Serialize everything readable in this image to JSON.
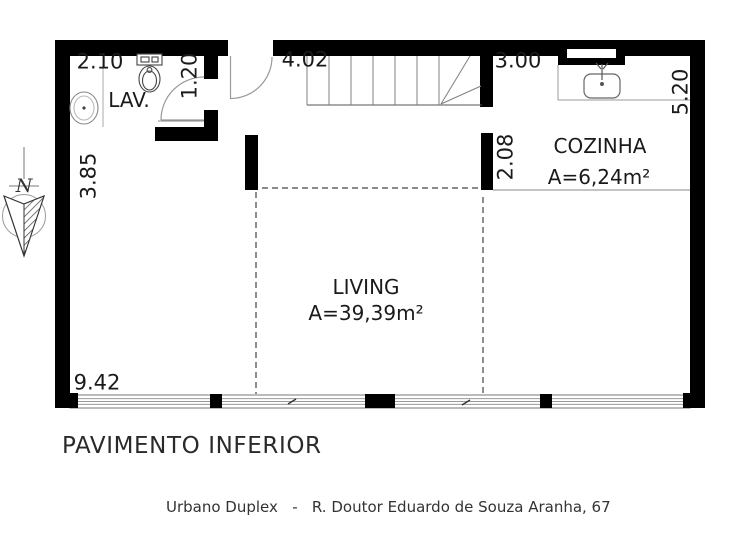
{
  "plan": {
    "title": "PAVIMENTO INFERIOR",
    "caption": "Urbano Duplex   -   R. Doutor Eduardo de Souza Aranha, 67",
    "compass": {
      "label": "N"
    },
    "rooms": {
      "lav": {
        "name": "LAV."
      },
      "cozinha": {
        "name": "COZINHA",
        "area": "A=6,24m²"
      },
      "living": {
        "name": "LIVING",
        "area": "A=39,39m²"
      }
    },
    "dimensions": {
      "lav_width": "2.10",
      "lav_door": "1.20",
      "entry": "4.02",
      "cozinha_width": "3.00",
      "cozinha_depth": "5.20",
      "wall_left": "3.85",
      "cozinha_opening": "2.08",
      "living_width": "9.42"
    },
    "colors": {
      "wall": "#000000",
      "text": "#1a1a1a",
      "caption": "#333333"
    }
  }
}
